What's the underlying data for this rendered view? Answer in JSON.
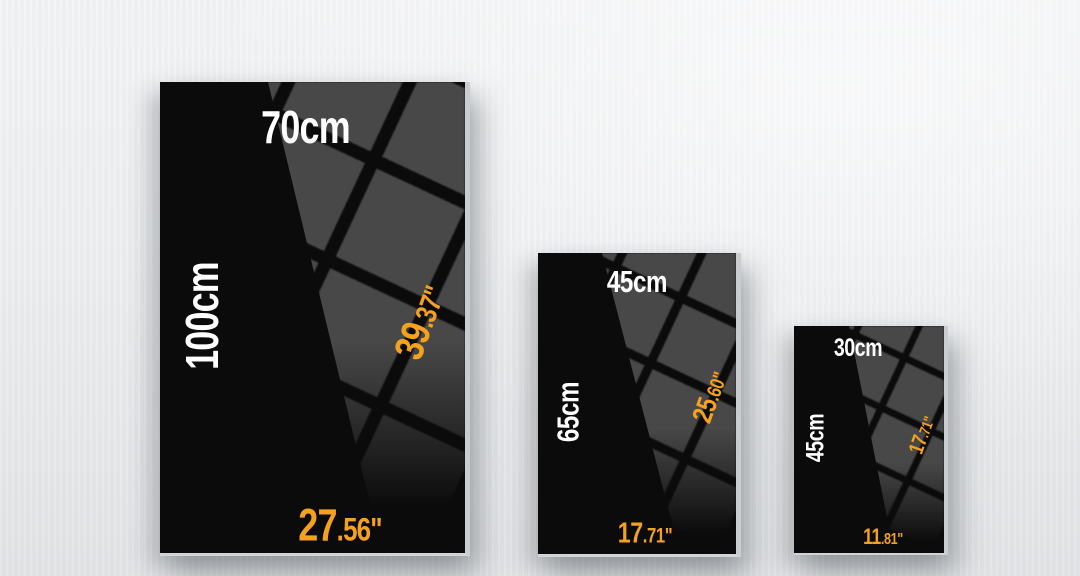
{
  "image_type": "canvas print size comparison infographic",
  "colors": {
    "accent_orange": "#F3A11F",
    "label_white": "#FFFFFF",
    "poster_black": "#0B0B0B",
    "reflection_gray": "#484848",
    "wall_gray": "#ECEEF0"
  },
  "posters": [
    {
      "name": "large",
      "width_cm_label": "70cm",
      "height_cm_label": "100cm",
      "height_in_main": "39",
      "height_in_small": ".37\"",
      "width_in_main": "27",
      "width_in_small": ".56\""
    },
    {
      "name": "medium",
      "width_cm_label": "45cm",
      "height_cm_label": "65cm",
      "height_in_main": "25",
      "height_in_small": ".60\"",
      "width_in_main": "17",
      "width_in_small": ".71\""
    },
    {
      "name": "small",
      "width_cm_label": "30cm",
      "height_cm_label": "45cm",
      "height_in_main": "17",
      "height_in_small": ".71\"",
      "width_in_main": "11",
      "width_in_small": ".81\""
    }
  ]
}
